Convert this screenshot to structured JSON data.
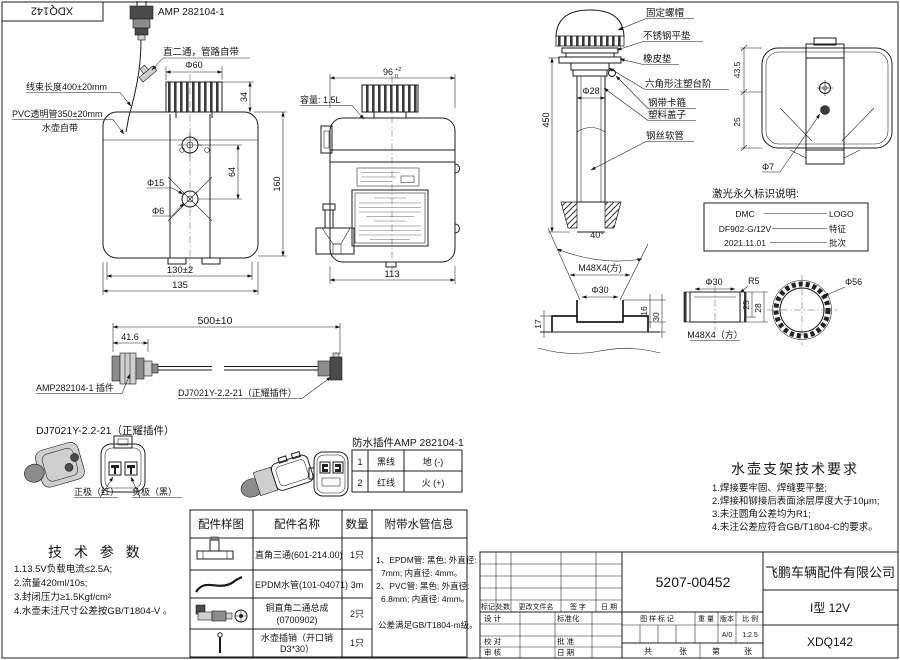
{
  "corner": {
    "code": "XDQ142"
  },
  "front": {
    "amp_label": "AMP 282104-1",
    "tee_callout": "直二通，管路自带",
    "harness_callout": "线束长度400±20mm",
    "pvc_callout": "PVC透明管350±20mm",
    "pvc_callout2": "水壶自带",
    "dim_d60": "Φ60",
    "dim_34": "34",
    "dim_d15": "Φ15",
    "dim_d6": "Φ6",
    "dim_64": "64",
    "dim_160": "160",
    "dim_130": "130±2",
    "dim_135": "135"
  },
  "side": {
    "dim_96": "96",
    "dim_96_up": "+2",
    "dim_96_dn": "0",
    "capacity": "容量: 1.5L",
    "dim_113": "113"
  },
  "pump": {
    "callouts": [
      "固定螺帽",
      "不锈钢平垫",
      "橡皮垫",
      "六角形注塑台阶",
      "钢带卡箍",
      "塑料盖子",
      "钢丝软管"
    ],
    "dim_d28": "Φ28",
    "dim_450": "450"
  },
  "bracket": {
    "dim_43_5": "43.5",
    "dim_25": "25",
    "dim_d7": "Φ7"
  },
  "laser": {
    "title": "激光永久标识说明:",
    "rows": [
      {
        "left": "DMC",
        "right": "LOGO"
      },
      {
        "left": "DF902-G/12V",
        "right": "特征"
      },
      {
        "left": "2021.11.01",
        "right": "批次"
      }
    ]
  },
  "neck": {
    "dim_angle": "40°",
    "dim_thread": "M48X4(方)",
    "dim_d30": "Φ30",
    "dim_17": "17",
    "dim_16": "16",
    "dim_30": "30"
  },
  "cap": {
    "dim_d30": "Φ30",
    "dim_r5": "R5",
    "dim_25": "25",
    "dim_28": "28",
    "dim_thread": "M48X4（方）",
    "dim_d56": "Φ56"
  },
  "cable": {
    "dim_500": "500±10",
    "dim_41_6": "41.6",
    "label_left": "AMP282104-1 插件",
    "label_right": "DJ7021Y-2.2-21（正耀插件）"
  },
  "conn": {
    "title": "DJ7021Y-2.2-21（正耀插件）",
    "positive": "正极（红）",
    "negative": "负极（黑）"
  },
  "wp": {
    "title": "防水插件AMP 282104-1",
    "rows": [
      {
        "no": "1",
        "wire": "黑线",
        "role": "地 (-)"
      },
      {
        "no": "2",
        "wire": "红线",
        "role": "火 (+)"
      }
    ]
  },
  "tech": {
    "title": "技 术 参 数",
    "lines": [
      "1.13.5V负载电流≤2.5A;",
      "2.流量420ml/10s;",
      "3.封闭压力≥1.5Kgf/cm²",
      "4.水壶未注尺寸公差按GB/T1804-V 。"
    ]
  },
  "parts": {
    "headers": [
      "配件样图",
      "配件名称",
      "数量",
      "附带水管信息"
    ],
    "rows": [
      {
        "name": "直角三通(601-214.00)",
        "qty": "1只"
      },
      {
        "name": "EPDM水管(101-04071)",
        "qty": "3m"
      },
      {
        "name": "铜直角二通总成",
        "name2": "(0700902)",
        "qty": "2只"
      },
      {
        "name": "水壶插销（开口销",
        "name2": "D3*30）",
        "qty": "1只"
      }
    ],
    "info": [
      "1、EPDM管: 黑色; 外直径:",
      "7mm; 内直径: 4mm。",
      "2、PVC管: 黑色; 外直径:",
      "6.8mm; 内直径: 4mm。",
      "公差满足GB/T1804-m级。"
    ]
  },
  "req": {
    "title": "水壶支架技术要求",
    "lines": [
      "1.焊接要牢固、焊缝要平整;",
      "2.焊接和铆接后表面涂层厚度大于10μm;",
      "3.未注圆角公差均为R1;",
      "4.未注公差应符合GB/T1804-C的要求。"
    ]
  },
  "tb": {
    "part_number": "5207-00452",
    "company": "飞鹏车辆配件有限公司",
    "model": "I型 12V",
    "drawing_no": "XDQ142",
    "version": "A/0",
    "scale": "1:2.5",
    "rev": [
      "标记",
      "处数",
      "更改文件名",
      "签 字",
      "日 期"
    ],
    "design": "设 计",
    "standard": "标准化",
    "check": "校 对",
    "approve": "批 准",
    "audit": "审 核",
    "date": "日 期",
    "mark_label": "图 样 标 记",
    "weight_label": "重 量",
    "ver_label": "版本",
    "scale_label": "比 例",
    "total_1": "共",
    "total_2": "张",
    "page_1": "第",
    "page_2": "张"
  }
}
